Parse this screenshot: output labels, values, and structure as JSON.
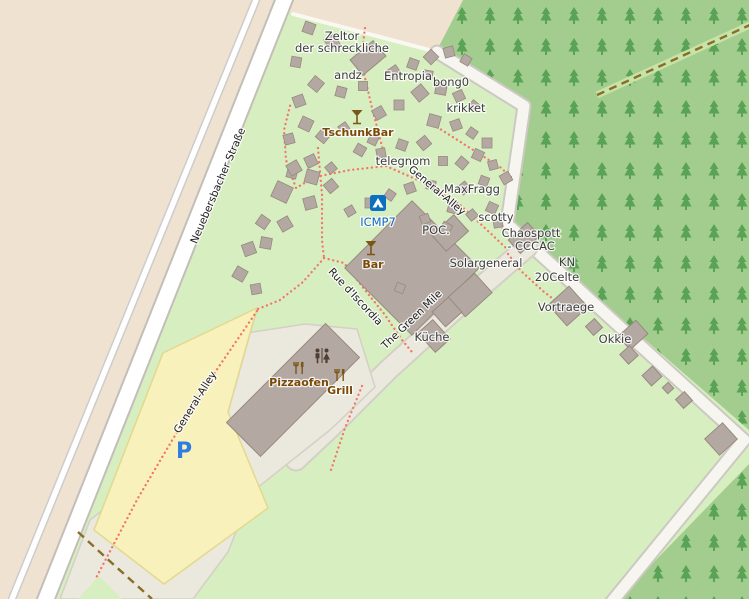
{
  "map": {
    "canvas": {
      "width": 749,
      "height": 599
    },
    "colors": {
      "camp_green": "#d7eec0",
      "farmland_tan": "#f0e2d0",
      "forest_green": "#a3cd8e",
      "tree_glyph": "#3f9340",
      "road_white": "#ffffff",
      "road_casing": "#c2beb8",
      "pedestrian_beige": "#ebe8dd",
      "pedestrian_casing": "#d3d0c6",
      "parking_yellow": "#f8f1bb",
      "parking_border": "#e3d98e",
      "building_fill": "#b4a9a2",
      "building_stroke": "#97897f",
      "footpath_dot": "#f2766a",
      "track_brown": "#8a6d28",
      "poi_brown": "#7a5718",
      "campsite_blue": "#0d6fc0",
      "label_blue": "#1268c3"
    },
    "areas": {
      "farmland": "0,0 463,0 437,52 283,10 44,599 0,599",
      "forest_upper": "463,0 749,0 749,430 510,222 527,104 437,50",
      "forest_lower": "749,464 749,599 618,599",
      "plaza": "214,338 305,324 357,329 375,387 330,430 252,492 228,552 193,599 60,599 90,520 228,412 257,309",
      "parking": "257,308 163,353 94,530 164,584 268,508 228,412",
      "green_patch": "78,599 99,576 122,599"
    },
    "roads": [
      {
        "name": "side-path",
        "points": "256,0 12,599",
        "casing_w": 8.5,
        "fill_w": 5.5,
        "fill": "#fefefe",
        "casing": "#cccccc"
      },
      {
        "name": "neuebersbacher-strasse",
        "points": "286,-5 44,604",
        "casing_w": 19,
        "fill_w": 15,
        "fill": "#ffffff",
        "casing": "#c2beb8"
      },
      {
        "name": "camp-top-path",
        "points": "293,14 437,52",
        "casing_w": 0,
        "fill_w": 4,
        "fill": "#faf8f2",
        "casing": "none"
      },
      {
        "name": "forest-edge-road",
        "points": "437,52 524,106 507,224 744,440 610,604",
        "casing_w": 15,
        "fill_w": 11,
        "fill": "#f7f5ef",
        "casing": "#ccc9c2"
      },
      {
        "name": "green-mile-road",
        "points": "527,247 452,312 388,370 330,428 296,460",
        "casing_w": 23,
        "fill_w": 19,
        "fill": "#ebe8dd",
        "casing": "#d3d0c6"
      }
    ],
    "forest_cut": {
      "stripe": "597,95 752,24",
      "stripe_color": "#c7e3a8",
      "stripe_w": 7
    },
    "tracks": [
      {
        "name": "track-southwest",
        "points": "78,532 114,565 152,599"
      },
      {
        "name": "track-forest",
        "points": "597,95 752,24"
      }
    ],
    "footpaths": [
      {
        "name": "path-zeltor-telegnom",
        "points": "365,28 361,60 372,108 383,150 386,166"
      },
      {
        "name": "path-general-alley-arc",
        "points": "386,166 420,181 458,203 487,230 506,248"
      },
      {
        "name": "path-west-arc",
        "points": "386,166 350,170 315,177 296,188 286,160 284,130 291,102"
      },
      {
        "name": "path-krikket",
        "points": "437,127 470,148 500,167 513,179"
      },
      {
        "name": "path-rue-upper",
        "points": "318,148 322,195 322,240 324,258"
      },
      {
        "name": "path-to-parking",
        "points": "324,258 303,282 280,300 258,309"
      },
      {
        "name": "path-rue-discordia",
        "points": "324,258 344,263 365,290 385,315 402,340 412,352"
      },
      {
        "name": "path-to-vortraege",
        "points": "508,254 521,271 543,291 557,302"
      },
      {
        "name": "path-parking-diag",
        "points": "257,311 196,400 138,498 96,578"
      },
      {
        "name": "path-grill-south",
        "points": "362,386 345,428 331,470"
      }
    ],
    "buildings": [
      [
        368,
        58,
        30,
        20,
        -40
      ],
      [
        412,
        268,
        95,
        95,
        45
      ],
      [
        450,
        233,
        30,
        22,
        -42
      ],
      [
        524,
        238,
        26,
        18,
        -42
      ],
      [
        470,
        295,
        36,
        26,
        -42
      ],
      [
        447,
        312,
        22,
        20,
        -42
      ],
      [
        434,
        336,
        20,
        26,
        -42
      ],
      [
        568,
        306,
        28,
        28,
        -42
      ],
      [
        633,
        335,
        24,
        18,
        -42
      ],
      [
        629,
        355,
        13,
        13,
        -42
      ],
      [
        594,
        327,
        12,
        12,
        -42
      ],
      [
        652,
        376,
        14,
        14,
        -42
      ],
      [
        668,
        388,
        8,
        8,
        -42
      ],
      [
        684,
        400,
        12,
        12,
        -42
      ],
      [
        721,
        439,
        24,
        22,
        -42
      ],
      [
        293,
        390,
        140,
        48,
        -45
      ]
    ],
    "tents": [
      [
        309,
        28,
        11,
        20
      ],
      [
        332,
        42,
        12,
        -30
      ],
      [
        296,
        62,
        10,
        10
      ],
      [
        316,
        84,
        12,
        40
      ],
      [
        299,
        101,
        11,
        -20
      ],
      [
        341,
        92,
        10,
        15
      ],
      [
        363,
        86,
        9,
        0
      ],
      [
        394,
        73,
        12,
        -35
      ],
      [
        413,
        64,
        10,
        20
      ],
      [
        431,
        57,
        11,
        45
      ],
      [
        449,
        52,
        10,
        -15
      ],
      [
        466,
        60,
        9,
        30
      ],
      [
        428,
        75,
        9,
        10
      ],
      [
        420,
        93,
        13,
        -40
      ],
      [
        441,
        89,
        11,
        10
      ],
      [
        459,
        96,
        10,
        -25
      ],
      [
        474,
        106,
        9,
        40
      ],
      [
        399,
        105,
        10,
        0
      ],
      [
        379,
        113,
        11,
        -30
      ],
      [
        306,
        124,
        12,
        25
      ],
      [
        289,
        139,
        10,
        -15
      ],
      [
        323,
        136,
        11,
        40
      ],
      [
        344,
        128,
        9,
        -35
      ],
      [
        434,
        121,
        12,
        15
      ],
      [
        456,
        125,
        10,
        -20
      ],
      [
        472,
        133,
        9,
        35
      ],
      [
        487,
        143,
        10,
        0
      ],
      [
        424,
        143,
        11,
        -40
      ],
      [
        402,
        145,
        10,
        20
      ],
      [
        381,
        153,
        9,
        -10
      ],
      [
        360,
        150,
        10,
        30
      ],
      [
        311,
        161,
        11,
        -25
      ],
      [
        292,
        173,
        10,
        15
      ],
      [
        331,
        168,
        9,
        -40
      ],
      [
        478,
        155,
        10,
        25
      ],
      [
        493,
        165,
        9,
        -15
      ],
      [
        462,
        163,
        10,
        40
      ],
      [
        443,
        161,
        9,
        0
      ],
      [
        506,
        178,
        10,
        -30
      ],
      [
        484,
        181,
        9,
        20
      ],
      [
        464,
        188,
        10,
        -40
      ],
      [
        431,
        185,
        9,
        10
      ],
      [
        410,
        188,
        10,
        -20
      ],
      [
        390,
        195,
        9,
        35
      ],
      [
        370,
        203,
        10,
        0
      ],
      [
        350,
        211,
        9,
        -30
      ],
      [
        453,
        208,
        10,
        15
      ],
      [
        472,
        215,
        9,
        -40
      ],
      [
        492,
        208,
        10,
        25
      ],
      [
        498,
        223,
        9,
        -10
      ],
      [
        446,
        228,
        10,
        30
      ],
      [
        425,
        219,
        9,
        -20
      ],
      [
        373,
        140,
        9,
        25
      ],
      [
        294,
        168,
        12,
        -30
      ],
      [
        312,
        177,
        13,
        15
      ],
      [
        331,
        186,
        11,
        -40
      ],
      [
        282,
        192,
        17,
        25
      ],
      [
        310,
        203,
        12,
        -15
      ],
      [
        263,
        222,
        11,
        35
      ],
      [
        285,
        224,
        12,
        -30
      ],
      [
        266,
        243,
        11,
        10
      ],
      [
        249,
        249,
        12,
        -20
      ],
      [
        240,
        274,
        12,
        30
      ],
      [
        256,
        289,
        10,
        -10
      ],
      [
        400,
        288,
        9,
        20
      ]
    ],
    "labels": [
      {
        "text": "Zeltor",
        "x": 342,
        "y": 40,
        "rot": 0,
        "style": "place"
      },
      {
        "text": "der schreckliche",
        "x": 342,
        "y": 52,
        "rot": 0,
        "style": "place"
      },
      {
        "text": "andz",
        "x": 348,
        "y": 79,
        "rot": 0,
        "style": "place"
      },
      {
        "text": "Entropia",
        "x": 408,
        "y": 80,
        "rot": 0,
        "style": "place"
      },
      {
        "text": "bong0",
        "x": 451,
        "y": 86,
        "rot": 0,
        "style": "place"
      },
      {
        "text": "krikket",
        "x": 466,
        "y": 112,
        "rot": 0,
        "style": "place"
      },
      {
        "text": "telegnom",
        "x": 403,
        "y": 165,
        "rot": 0,
        "style": "place"
      },
      {
        "text": "MaxFragg",
        "x": 472,
        "y": 193,
        "rot": 0,
        "style": "place"
      },
      {
        "text": "scotty",
        "x": 496,
        "y": 221,
        "rot": 0,
        "style": "place"
      },
      {
        "text": "Chaospott",
        "x": 531,
        "y": 237,
        "rot": 0,
        "style": "place"
      },
      {
        "text": "- CCCAC",
        "x": 531,
        "y": 250,
        "rot": 0,
        "style": "place"
      },
      {
        "text": "POC.",
        "x": 436,
        "y": 234,
        "rot": 0,
        "style": "place"
      },
      {
        "text": "Solargeneral",
        "x": 486,
        "y": 267,
        "rot": 0,
        "style": "place"
      },
      {
        "text": "KN",
        "x": 567,
        "y": 266,
        "rot": 0,
        "style": "place"
      },
      {
        "text": "20Celte",
        "x": 557,
        "y": 281,
        "rot": 0,
        "style": "place"
      },
      {
        "text": "Vortraege",
        "x": 566,
        "y": 311,
        "rot": 0,
        "style": "place"
      },
      {
        "text": "Okkie",
        "x": 615,
        "y": 343,
        "rot": 0,
        "style": "place"
      },
      {
        "text": "Küche",
        "x": 432,
        "y": 341,
        "rot": 0,
        "style": "place"
      },
      {
        "text": "TschunkBar",
        "x": 358,
        "y": 136,
        "rot": 0,
        "style": "poi"
      },
      {
        "text": "Bar",
        "x": 373,
        "y": 268,
        "rot": 0,
        "style": "poi"
      },
      {
        "text": "Pizzaofen",
        "x": 299,
        "y": 386,
        "rot": 0,
        "style": "poi"
      },
      {
        "text": "Grill",
        "x": 340,
        "y": 394,
        "rot": 0,
        "style": "poi"
      },
      {
        "text": "ICMP7",
        "x": 378,
        "y": 226,
        "rot": 0,
        "style": "blue"
      },
      {
        "text": "Neuebersbacher Straße",
        "x": 221,
        "y": 187,
        "rot": -67,
        "style": "street"
      },
      {
        "text": "General-Alley",
        "x": 435,
        "y": 193,
        "rot": 40,
        "style": "street"
      },
      {
        "text": "Rue d'Iscordia",
        "x": 353,
        "y": 299,
        "rot": 47,
        "style": "street"
      },
      {
        "text": "The Green Mile",
        "x": 414,
        "y": 322,
        "rot": -44,
        "style": "street"
      },
      {
        "text": "General-Alley",
        "x": 198,
        "y": 404,
        "rot": -58,
        "style": "street"
      }
    ],
    "icons": [
      {
        "type": "campsite",
        "name": "campsite-icon",
        "x": 378,
        "y": 203
      },
      {
        "type": "cocktail",
        "name": "tschunkbar-cocktail-icon",
        "x": 357,
        "y": 117
      },
      {
        "type": "cocktail",
        "name": "bar-cocktail-icon",
        "x": 371,
        "y": 248
      },
      {
        "type": "restaurant",
        "name": "pizzaofen-restaurant-icon",
        "x": 299,
        "y": 368
      },
      {
        "type": "restaurant",
        "name": "grill-restaurant-icon",
        "x": 340,
        "y": 375
      },
      {
        "type": "toilets",
        "name": "toilets-icon",
        "x": 322,
        "y": 356
      },
      {
        "type": "parking",
        "name": "parking-icon",
        "x": 184,
        "y": 458,
        "text": "P"
      }
    ]
  }
}
